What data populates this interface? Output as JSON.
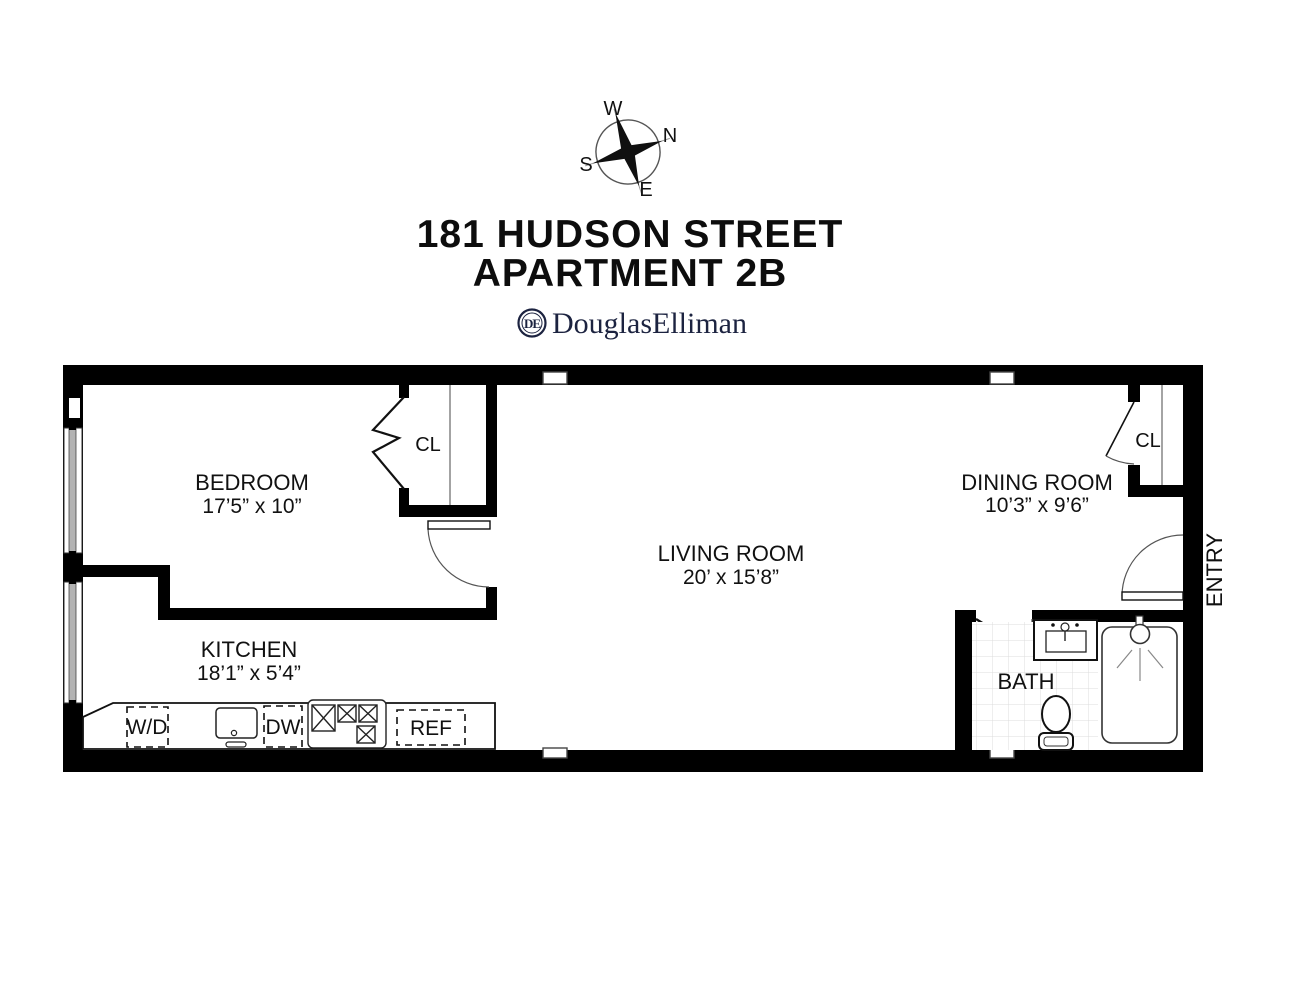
{
  "title": {
    "line1": "181 HUDSON STREET",
    "line2": "APARTMENT 2B"
  },
  "brand": {
    "name": "DouglasElliman",
    "monogram": "DE"
  },
  "compass": {
    "west": "W",
    "north": "N",
    "south": "S",
    "east": "E"
  },
  "rooms": {
    "bedroom": {
      "name": "BEDROOM",
      "dims": "17’5” x 10”"
    },
    "kitchen": {
      "name": "KITCHEN",
      "dims": "18’1” x 5’4”"
    },
    "living": {
      "name": "LIVING ROOM",
      "dims": "20’ x 15’8”"
    },
    "dining": {
      "name": "DINING ROOM",
      "dims": "10’3” x 9’6”"
    },
    "bath": {
      "name": "BATH"
    },
    "entry": {
      "name": "ENTRY"
    },
    "bedroom_closet": {
      "name": "CL"
    },
    "dining_closet": {
      "name": "CL"
    }
  },
  "appliances": {
    "washer_dryer": "W/D",
    "dishwasher": "DW",
    "refrigerator": "REF"
  },
  "colors": {
    "wall": "#000000",
    "brand_navy": "#1c2340",
    "window_gray": "#b3b3b3",
    "tile_line": "#dcdcdc"
  }
}
